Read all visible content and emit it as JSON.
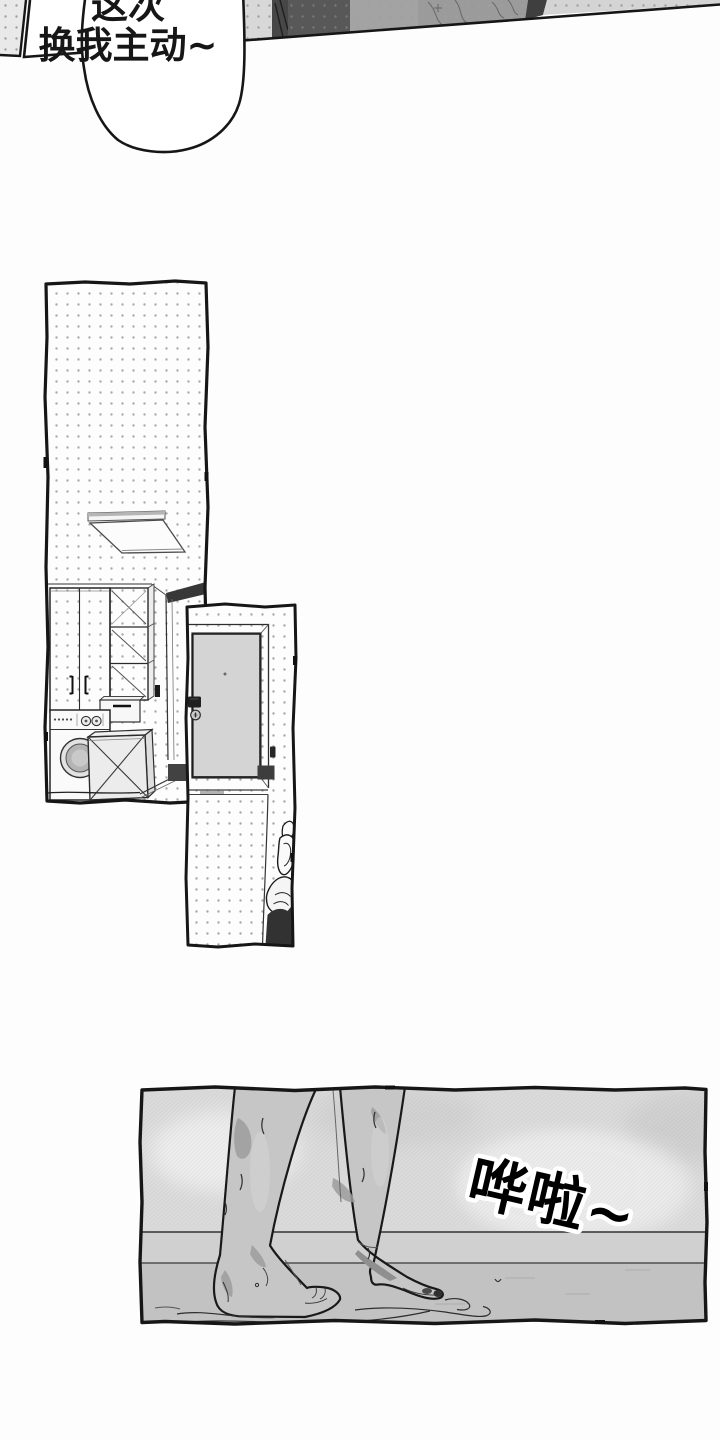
{
  "bubble": {
    "line1": "这次",
    "line2": "换我主动~"
  },
  "sfx": {
    "text": "哗啦~"
  },
  "colors": {
    "ink": "#161616",
    "paper": "#fdfdfd",
    "dot": "#a9a9a9",
    "door": "#d4d4d4",
    "fabric-dark": "#585858",
    "fabric-mid": "#a3a3a3",
    "fabric-light": "#d5d5d5",
    "wall": "#dadada",
    "baseboard": "#d0d0d0",
    "floor": "#c2c2c2",
    "leg": "#c6c6c6",
    "leg-shadow": "#9c9c9c",
    "clothing-dark": "#323232"
  }
}
